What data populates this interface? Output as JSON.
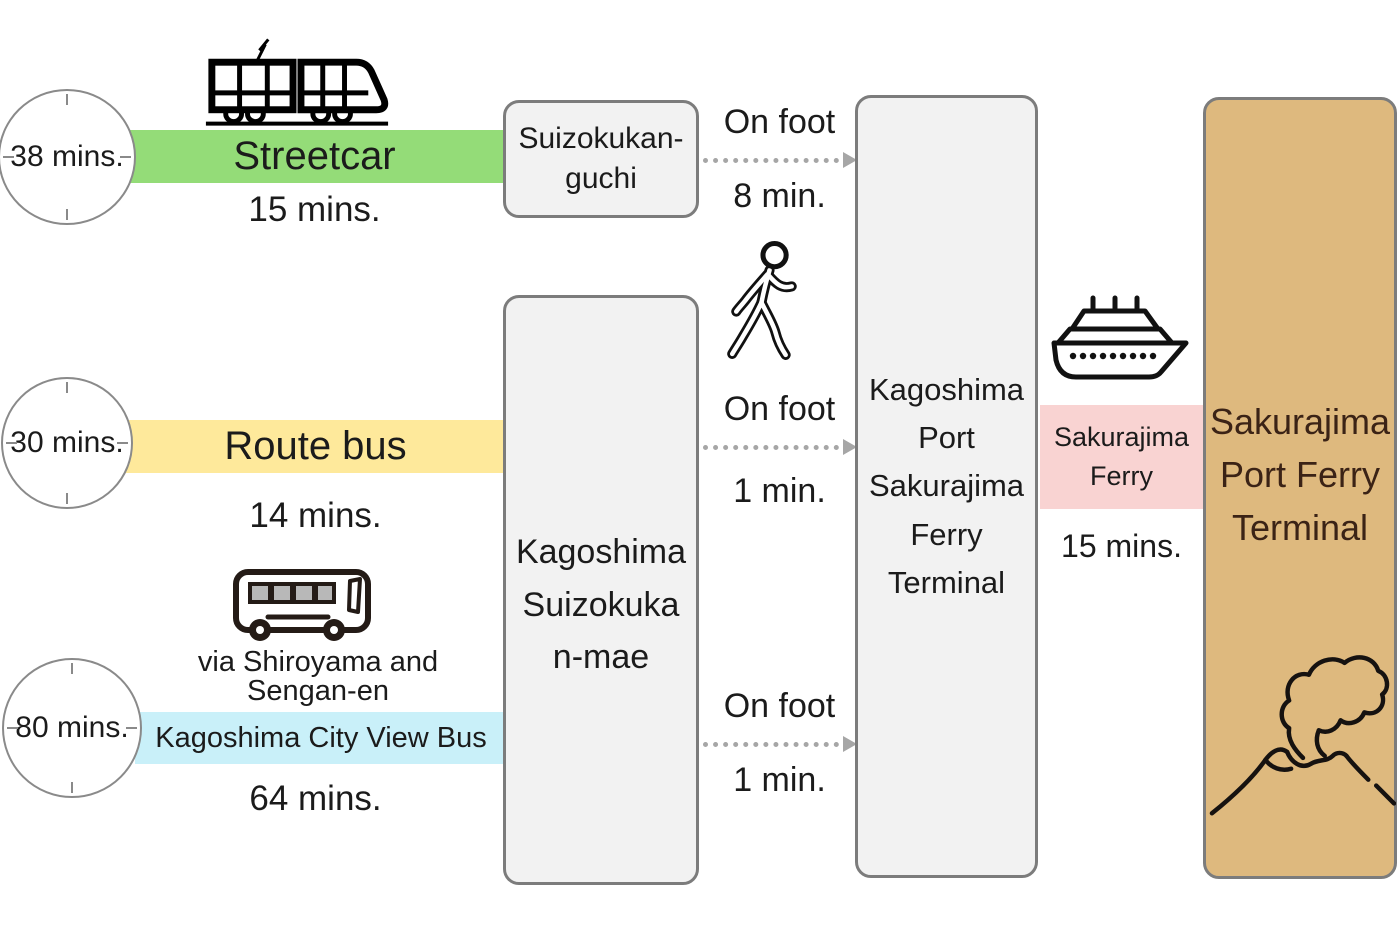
{
  "routes": [
    {
      "total_time": "38 mins.",
      "mode": "Streetcar",
      "duration": "15 mins.",
      "bar_color": "#94DC78",
      "icon": "streetcar-icon"
    },
    {
      "total_time": "30 mins.",
      "mode": "Route bus",
      "duration": "14 mins.",
      "bar_color": "#FEE99B",
      "icon": ""
    },
    {
      "total_time": "80 mins.",
      "mode": "Kagoshima City View Bus",
      "duration": "64 mins.",
      "bar_color": "#C9F0F9",
      "via_line1": "via Shiroyama and",
      "via_line2": "Sengan-en",
      "icon": "bus-icon"
    }
  ],
  "stations": {
    "suizokukan_guchi": {
      "line1": "Suizokukan-",
      "line2": "guchi"
    },
    "suizokukan_mae": {
      "line1": "Kagoshima",
      "line2": "Suizokuka",
      "line3": "n-mae"
    },
    "kagoshima_port": {
      "line1": "Kagoshima",
      "line2": "Port",
      "line3": "Sakurajima",
      "line4": "Ferry",
      "line5": "Terminal"
    },
    "sakurajima_port": {
      "line1": "Sakurajima",
      "line2": "Port Ferry",
      "line3": "Terminal"
    }
  },
  "walks": [
    {
      "label": "On foot",
      "duration": "8 min."
    },
    {
      "label": "On foot",
      "duration": "1 min."
    },
    {
      "label": "On foot",
      "duration": "1 min."
    }
  ],
  "ferry": {
    "name_line1": "Sakurajima",
    "name_line2": "Ferry",
    "duration": "15 mins.",
    "label_color": "#F9D3D2"
  },
  "colors": {
    "station_box_fill": "#F2F2F2",
    "station_box_border": "#7C7C7C",
    "destination_fill": "#DEB97E",
    "destination_text": "#3B2316",
    "arrow": "#A6A6A6"
  }
}
